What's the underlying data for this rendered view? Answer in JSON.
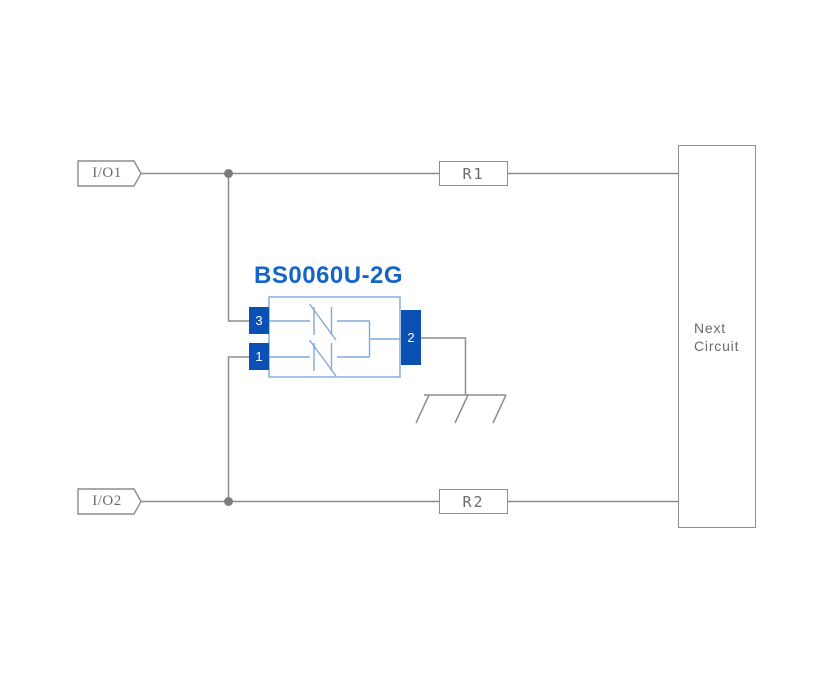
{
  "diagram": {
    "io_tag_top": "I/O1",
    "io_tag_bottom": "I/O2",
    "resistor_top": "R1",
    "resistor_bottom": "R2",
    "next_circuit": {
      "line1": "Next",
      "line2": "Circuit"
    },
    "component": {
      "name": "BS0060U-2G",
      "pin_left_top": "3",
      "pin_left_bottom": "1",
      "pin_right": "2"
    },
    "icons": {
      "junction": "junction-dot",
      "ground": "chassis-ground-icon",
      "element": "bidirectional-suppressor-icon"
    },
    "colors": {
      "wire": "#8d8d8d",
      "junction_dot": "#7d7d7d",
      "label_text": "#6b6b6b",
      "component_pin": "#0a50b5",
      "component_outline": "#7fa9da",
      "component_title": "#1565c8",
      "background": "#ffffff"
    }
  }
}
